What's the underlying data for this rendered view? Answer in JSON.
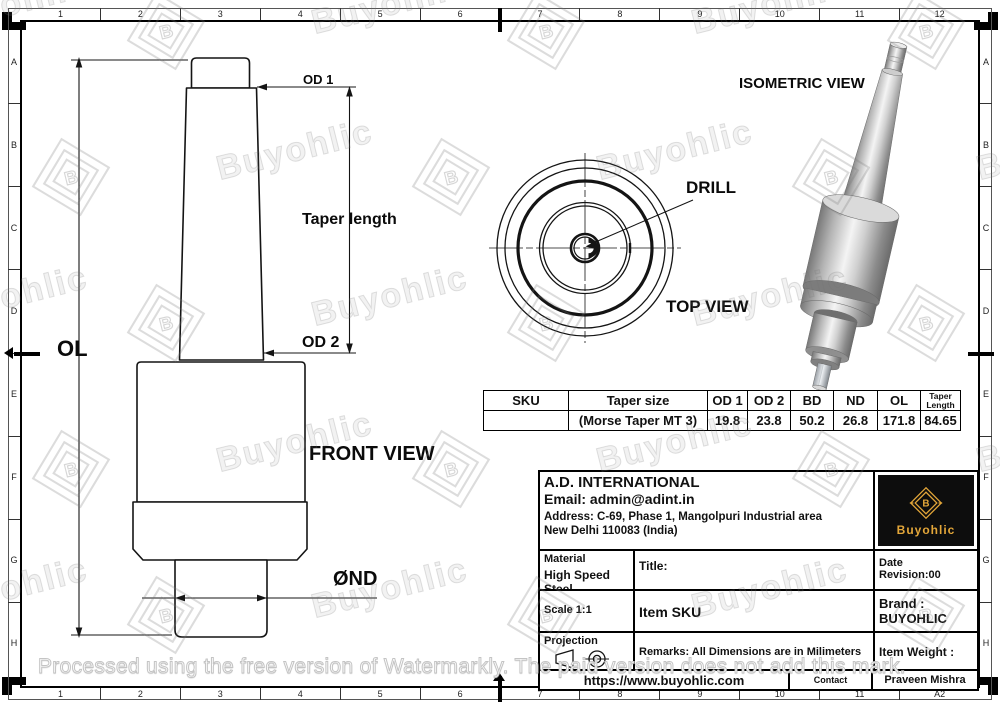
{
  "drawing": {
    "labels": {
      "od1": "OD 1",
      "od2": "OD 2",
      "ol": "OL",
      "taper_length": "Taper length",
      "nd": "ØND",
      "front_view": "FRONT VIEW",
      "top_view": "TOP VIEW",
      "isometric_view": "ISOMETRIC VIEW",
      "drill": "DRILL"
    }
  },
  "spec_table": {
    "headers": [
      "SKU",
      "Taper size",
      "OD 1",
      "OD 2",
      "BD",
      "ND",
      "OL",
      "Taper Length"
    ],
    "row": [
      "",
      "(Morse Taper MT 3)",
      "19.8",
      "23.8",
      "50.2",
      "26.8",
      "171.8",
      "84.65"
    ]
  },
  "title_block": {
    "company": "A.D. INTERNATIONAL",
    "email": "Email: admin@adint.in",
    "address_line1": "Address: C-69, Phase 1, Mangolpuri Industrial area",
    "address_line2": "New Delhi 110083 (India)",
    "material_label": "Material",
    "material_value": "High Speed Steel",
    "title_label": "Title:",
    "date_label": "Date",
    "revision": "Revision:00",
    "scale": "Scale 1:1",
    "item_sku": "Item SKU",
    "brand_label": "Brand :",
    "brand_value": "BUYOHLIC",
    "projection_label": "Projection",
    "remarks": "Remarks: All Dimensions are in Milimeters",
    "item_weight_label": "Item Weight :",
    "website": "https://www.buyohlic.com",
    "contact_label": "Contact",
    "contact_name": "Praveen Mishra",
    "logo_text": "Buyohlic",
    "logo_letter": "B",
    "logo_gold": "#E3A639"
  },
  "grid": {
    "columns": [
      "1",
      "2",
      "3",
      "4",
      "5",
      "6",
      "7",
      "8",
      "9",
      "10",
      "11",
      "12"
    ],
    "rows": [
      "A",
      "B",
      "C",
      "D",
      "E",
      "F",
      "G",
      "H"
    ],
    "sheet_size": "A2"
  },
  "watermark": {
    "text": "Buyohlic",
    "notice": "Processed using the free version of Watermarkly. The paid version does not add this mark."
  }
}
